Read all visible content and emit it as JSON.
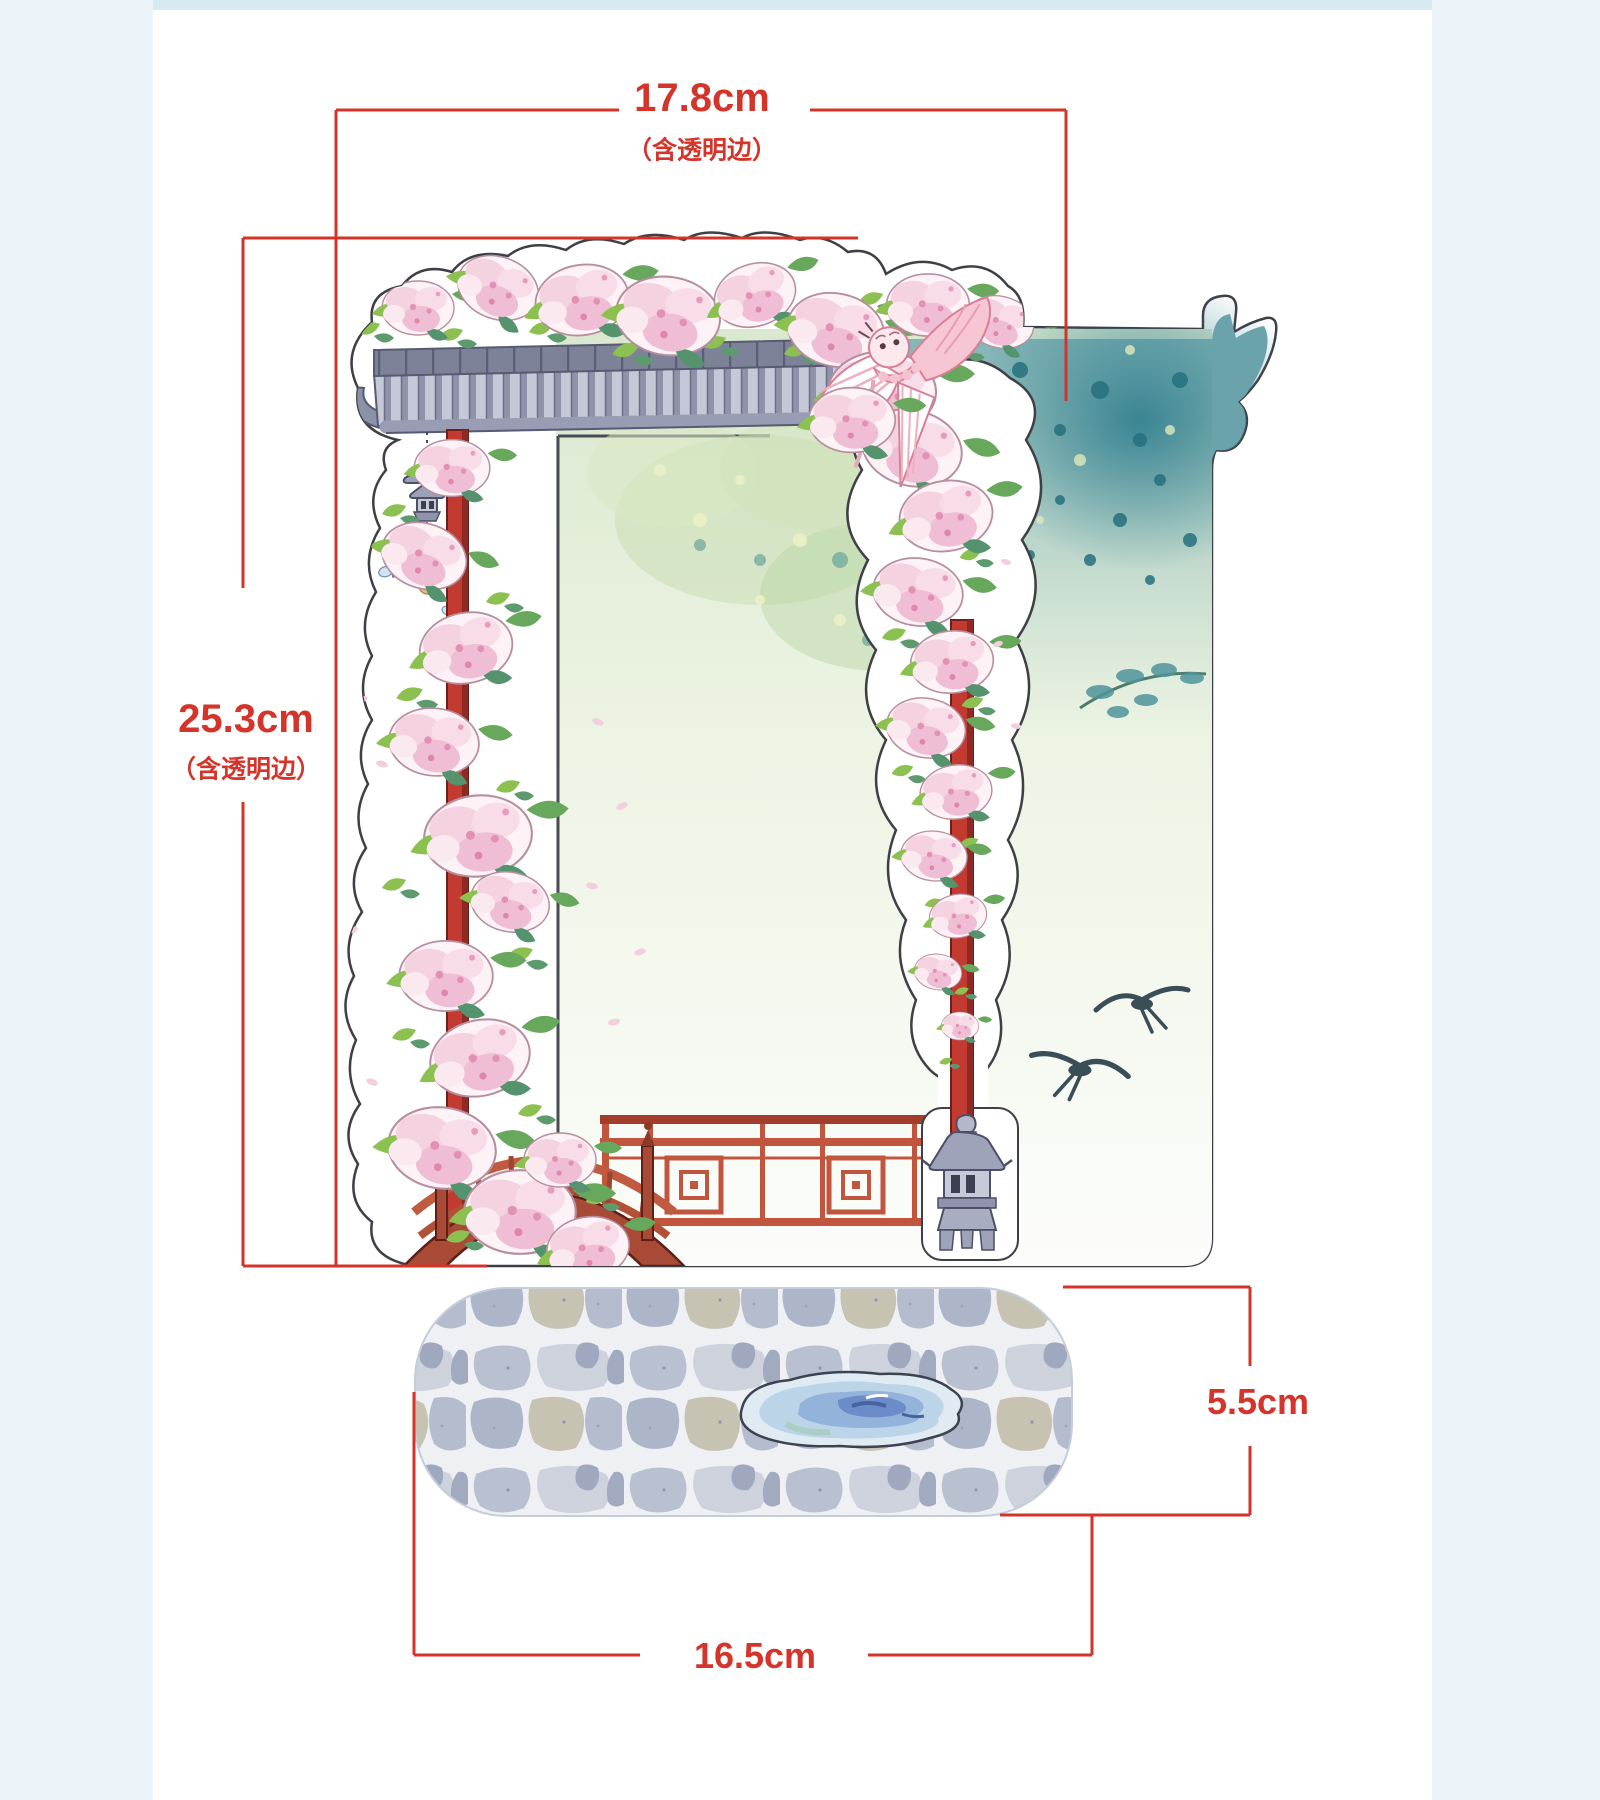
{
  "page": {
    "background": "#ffffff",
    "type": "product-dimension-diagram"
  },
  "colors": {
    "accent_red": "#d4342a",
    "side_strip": "#edf4f9",
    "top_band": "#d7e9f1",
    "sticker_outline": "#3f3f46",
    "pillar_red": "#c23a30",
    "fence_red": "#c2553d",
    "bridge_brown": "#a84a36",
    "roof_gray": "#b9bdcf",
    "teal_deep": "#2f7e8e",
    "teal_soft": "#6aa3ab",
    "leaf_green": "#8cc152",
    "blossom_pink": "#f5d2e0",
    "stone_gray": "#b9c0d0",
    "puddle_blue": "#8fb0d8"
  },
  "dimensions": {
    "top": {
      "value": "17.8cm",
      "note": "（含透明边）"
    },
    "left": {
      "value": "25.3cm",
      "note": "（含透明边）"
    },
    "right": {
      "value": "5.5cm"
    },
    "bottom": {
      "value": "16.5cm"
    }
  },
  "artwork": {
    "scene": "Chinese garden spring die-cut sheet with cobblestone base",
    "elements": [
      "tiled-roof-eave",
      "pagoda-wind-chime",
      "butterflies",
      "left-red-pillar",
      "right-red-pillar",
      "blossom-vine",
      "blossom-cascade",
      "swallow-kite",
      "teal-tree-canopy",
      "roof-corner-silhouette",
      "flying-swallows",
      "arched-wooden-bridge",
      "red-lattice-fence",
      "stone-lantern",
      "cobblestone-base",
      "water-puddle"
    ]
  }
}
